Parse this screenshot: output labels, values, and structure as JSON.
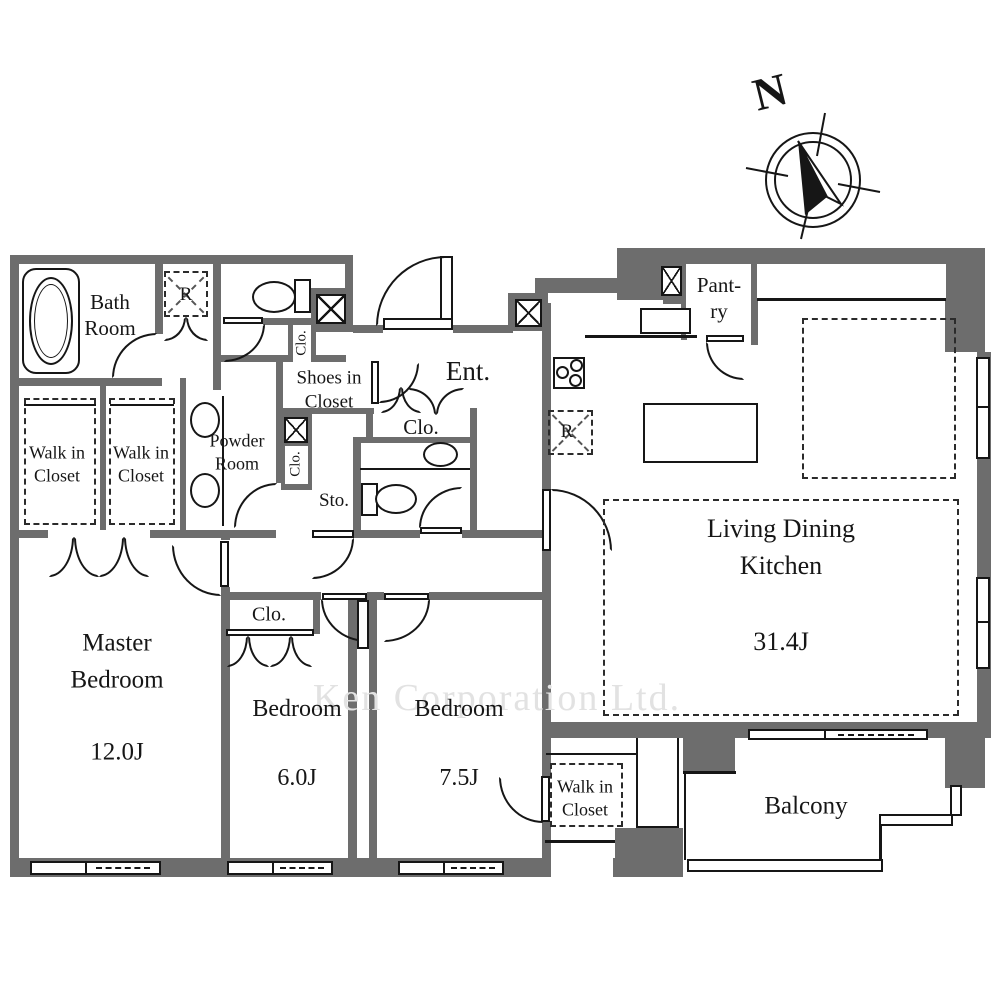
{
  "compass": {
    "north": "N"
  },
  "watermark": "Ken Corporation Ltd.",
  "rooms": {
    "bath": {
      "name": "Bath\nRoom"
    },
    "utility_r": {
      "mark": "R"
    },
    "walk_in_closet_1": {
      "name": "Walk in\nCloset"
    },
    "walk_in_closet_2": {
      "name": "Walk in\nCloset"
    },
    "powder": {
      "name": "Powder\nRoom"
    },
    "shoes_closet": {
      "name": "Shoes in\nCloset"
    },
    "closet_by_toilet": {
      "name": "Clo."
    },
    "closet_by_storage": {
      "name": "Clo."
    },
    "storage": {
      "name": "Sto."
    },
    "entrance": {
      "name": "Ent."
    },
    "closet_entrance": {
      "name": "Clo."
    },
    "pantry": {
      "name": "Pant-\nry"
    },
    "fridge_r": {
      "mark": "R"
    },
    "ldk": {
      "name": "Living Dining Kitchen",
      "area": "31.4J"
    },
    "master_bedroom": {
      "name": "Master\nBedroom",
      "area": "12.0J"
    },
    "bedroom_6": {
      "name": "Bedroom",
      "area": "6.0J"
    },
    "bedroom_75": {
      "name": "Bedroom",
      "area": "7.5J"
    },
    "closet_bedroom6": {
      "name": "Clo."
    },
    "walk_in_closet_3": {
      "name": "Walk in\nCloset"
    },
    "balcony": {
      "name": "Balcony"
    }
  }
}
